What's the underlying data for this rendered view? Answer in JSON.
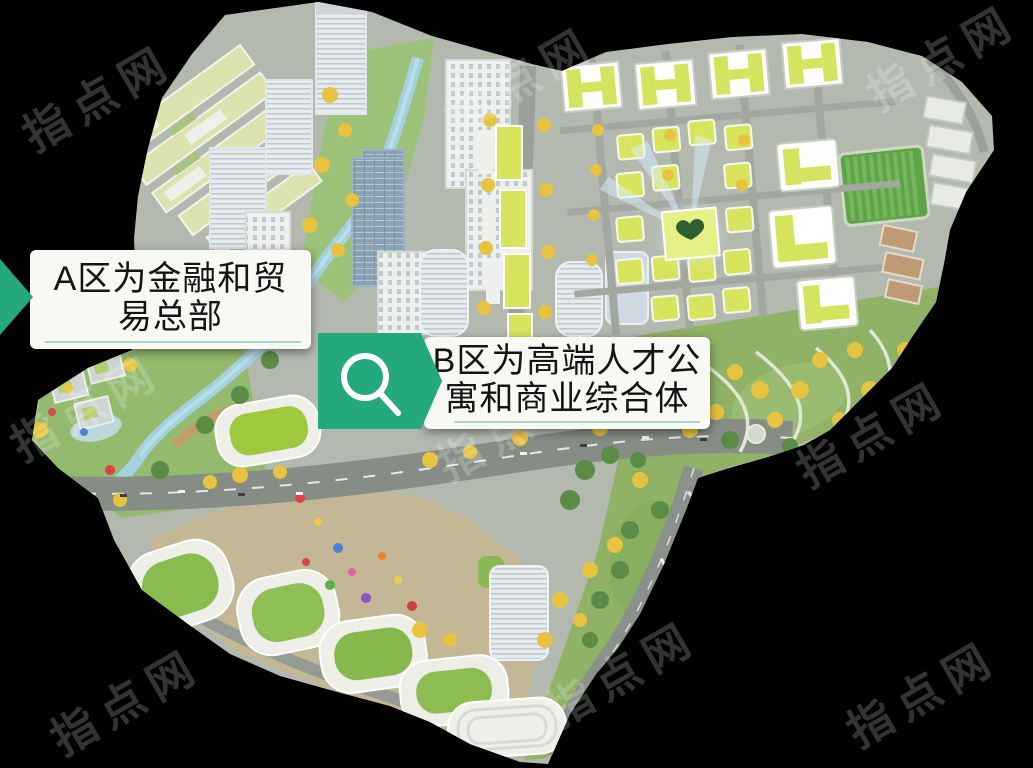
{
  "annotations": {
    "area_a": {
      "line1": "A区为金融和贸",
      "line2": "易总部"
    },
    "area_b": {
      "line1": "B区为高端人才公",
      "line2": "寓和商业综合体"
    }
  },
  "watermark": {
    "text": "指点网"
  },
  "colors": {
    "background": "#000000",
    "accent_green": "#23a97d",
    "underline_green": "#a7d9bc",
    "label_background": "#f8f8f4",
    "label_text": "#141414"
  },
  "icons": {
    "area_a_pointer": "chevron-right-icon",
    "area_b_badge": "magnifier-icon"
  }
}
